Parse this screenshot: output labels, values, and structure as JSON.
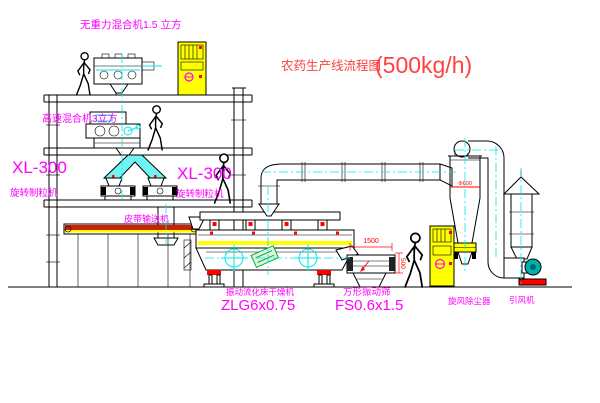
{
  "title": {
    "name": "农药生产线流程图",
    "capacity": "(500kg/h)"
  },
  "labels": {
    "gravity_free_mixer": "无重力混合机1.5 立方",
    "high_speed_mixer": "高速混合机3立方",
    "xl300_left": "XL-300",
    "granulator_left": "旋转制粒机",
    "xl300_center": "XL-300",
    "granulator_center": "旋转制粒机",
    "belt_conveyor": "皮带输送机",
    "dryer_name": "振动流化床干燥机",
    "dryer_model": "ZLG6x0.75",
    "sieve_name": "方形振动筛",
    "sieve_model": "FS0.6x1.5",
    "cyclone": "旋风除尘器",
    "fan": "引风机"
  },
  "dimensions": {
    "sieve_length": "1500",
    "sieve_height": "500",
    "cyclone_dia": "Φ600"
  },
  "colors": {
    "label": "#ff00ff",
    "title": "#ff4040",
    "dimension": "#ff0000",
    "centerline": "#00e8e8",
    "cabinet": "#ffff00",
    "line": "#000000"
  }
}
